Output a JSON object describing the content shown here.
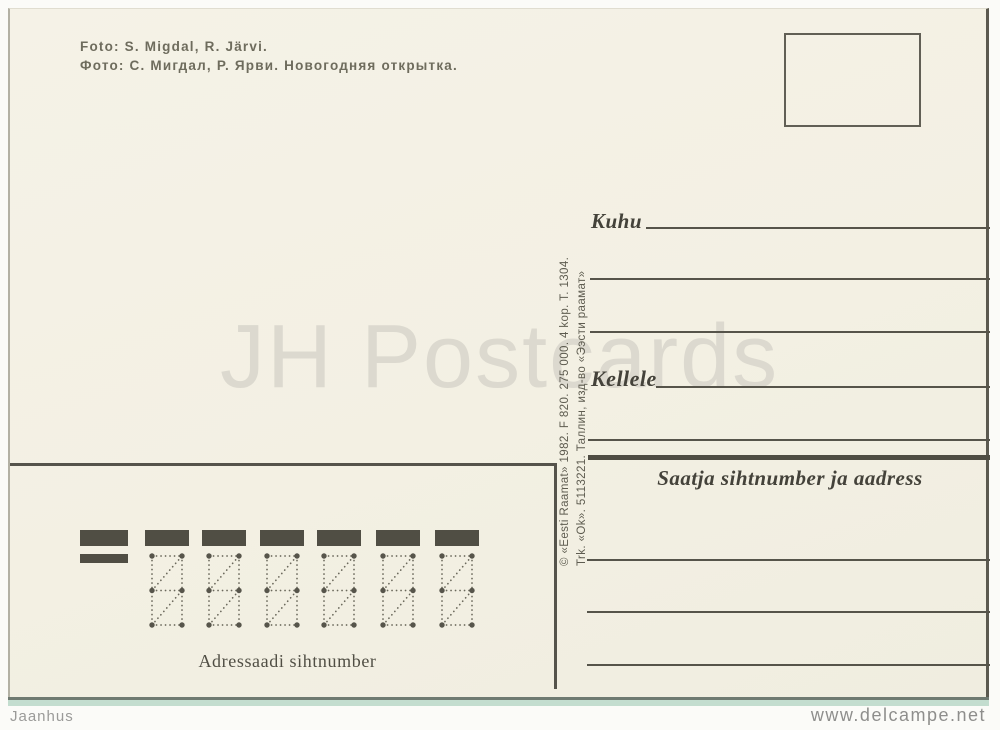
{
  "page": {
    "watermark_text": "JH Postcards",
    "footer_left": "Jaanhus",
    "footer_right": "www.delcampe.net"
  },
  "postcard": {
    "photo_credit": {
      "line1": "Foto: S. Migdal, R. Järvi.",
      "line2": "Фото: С. Мигдал, Р. Ярви. Новогодняя открытка."
    },
    "imprint": {
      "line1": "© «Eesti Raamat» 1982. F 820. 275 000. 4 kop. T. 1304.",
      "line2": "Trk. «Ok». 5113221. Таллин, изд-во «Ээсти раамат»"
    },
    "address_fields": {
      "kuhu_label": "Kuhu",
      "kellele_label": "Kellele",
      "sender_label": "Saatja sihtnumber ja aadress"
    },
    "postal_code": {
      "label": "Adressaadi sihtnumber",
      "cells": 6
    },
    "colors": {
      "card_background": "#f3f0e3",
      "print_ink": "#55534a",
      "credit_ink": "#6e6c5d",
      "watermark": "#dcd9cf",
      "footer_text": "#979795",
      "card_edge_teal": "#c3ddcf"
    }
  }
}
